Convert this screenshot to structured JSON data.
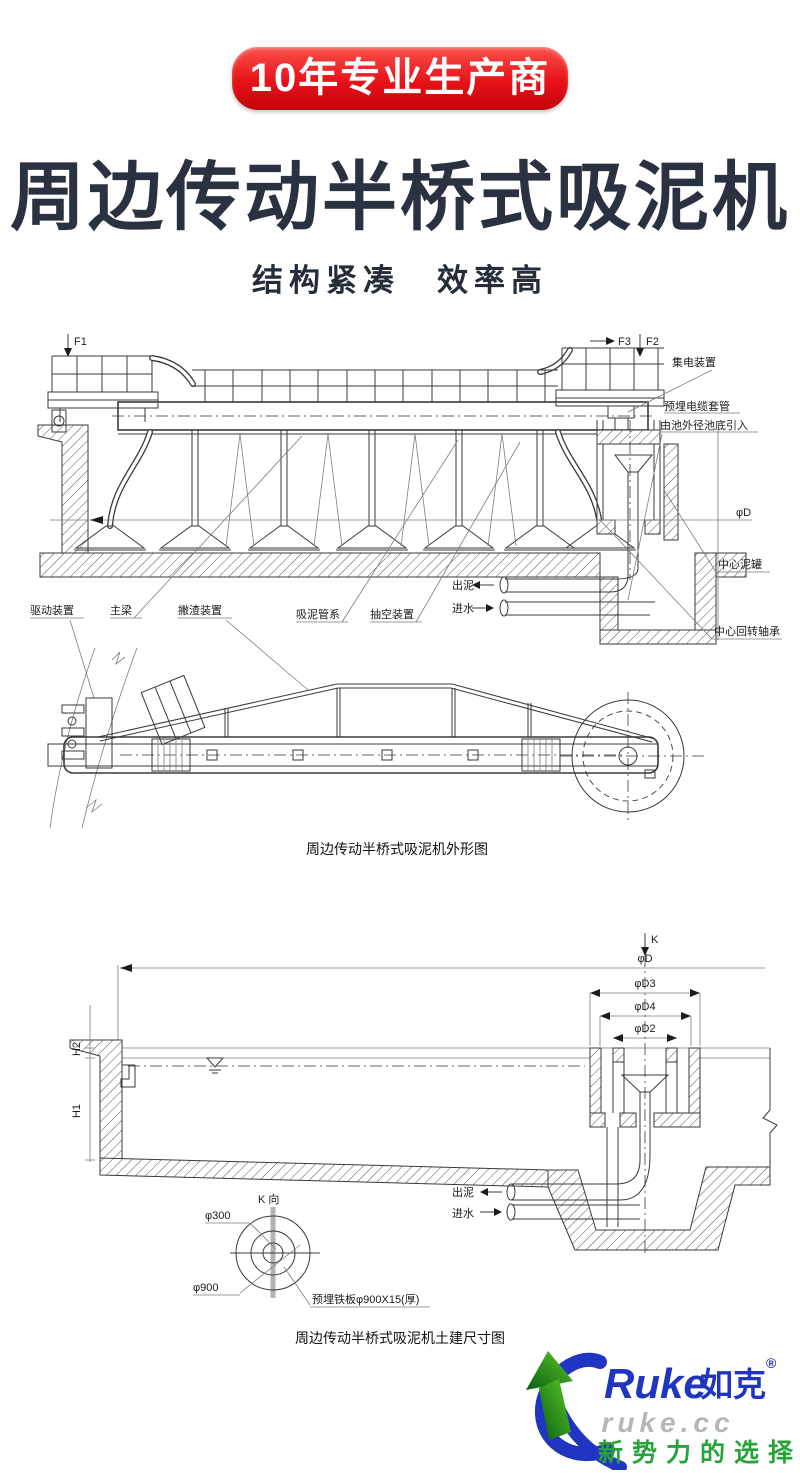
{
  "badge": {
    "label": "10年专业生产商"
  },
  "header": {
    "title": "周边传动半桥式吸泥机",
    "subtitle": "结构紧凑　效率高"
  },
  "drawing1": {
    "caption": "周边传动半桥式吸泥机外形图",
    "labels": {
      "f1": "F1",
      "f3": "F3",
      "f2": "F2",
      "collector": "集电装置",
      "cable_sleeve": "预埋电缆套管",
      "cable_leadin": "由池外径池底引入",
      "dia_d": "φD",
      "center_mud_tank": "中心泥罐",
      "center_bearing": "中心回转轴承",
      "drive_unit": "驱动装置",
      "main_beam": "主梁",
      "skimmer": "撇渣装置",
      "suction_pipes": "吸泥管系",
      "vacuum_unit": "抽空装置",
      "mud_out": "出泥",
      "water_in": "进水"
    }
  },
  "drawing2": {
    "caption": "周边传动半桥式吸泥机土建尺寸图",
    "labels": {
      "k": "K",
      "k_view": "K 向",
      "dia_d": "φD",
      "dia_d3": "φD3",
      "dia_d4": "φD4",
      "dia_d2": "φD2",
      "h1": "H1",
      "h2": "H2",
      "mud_out": "出泥",
      "water_in": "进水",
      "dia_300": "φ300",
      "dia_900": "φ900",
      "embedded_plate": "预埋铁板φ900X15(厚)"
    }
  },
  "logo": {
    "brand_en": "Ruke",
    "brand_cn": "如克",
    "registered": "®",
    "watermark": "ruke.cc",
    "slogan": "新势力的选择",
    "blue": "#2136c0",
    "green": "#27a33c"
  }
}
